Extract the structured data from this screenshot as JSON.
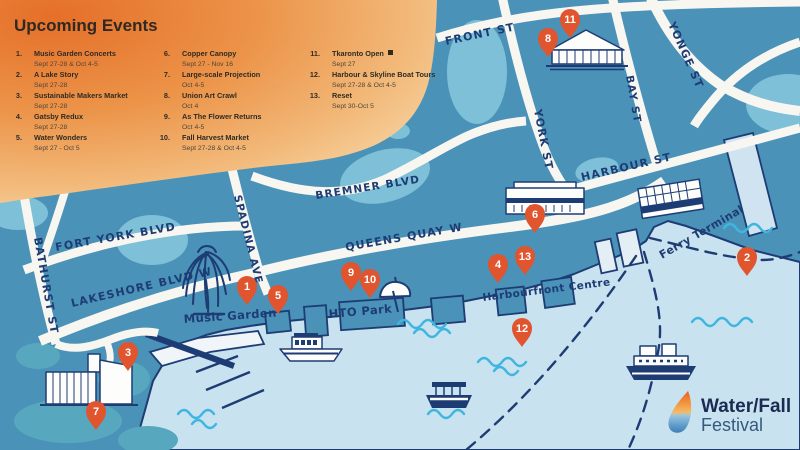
{
  "legend": {
    "title": "Upcoming Events",
    "items": [
      {
        "num": "1.",
        "name": "Music Garden Concerts",
        "dates": "Sept 27-28 & Oct 4-5"
      },
      {
        "num": "2.",
        "name": "A Lake Story",
        "dates": "Sept 27-28"
      },
      {
        "num": "3.",
        "name": "Sustainable Makers Market",
        "dates": "Sept 27-28"
      },
      {
        "num": "4.",
        "name": "Gatsby Redux",
        "dates": "Sept 27-28"
      },
      {
        "num": "5.",
        "name": "Water Wonders",
        "dates": "Sept 27 - Oct 5"
      },
      {
        "num": "6.",
        "name": "Copper Canopy",
        "dates": "Sept 27 - Nov 16"
      },
      {
        "num": "7.",
        "name": "Large-scale Projection",
        "dates": "Oct 4-5"
      },
      {
        "num": "8.",
        "name": "Union Art Crawl",
        "dates": "Oct 4"
      },
      {
        "num": "9.",
        "name": "As The Flower Returns",
        "dates": "Oct 4-5"
      },
      {
        "num": "10.",
        "name": "Fall Harvest Market",
        "dates": "Sept 27-28 & Oct 4-5"
      },
      {
        "num": "11.",
        "name": "Tkaronto Open",
        "dates": "Sept 27"
      },
      {
        "num": "12.",
        "name": "Harbour & Skyline Boat Tours",
        "dates": "Sept 27-28 & Oct 4-5"
      },
      {
        "num": "13.",
        "name": "Reset",
        "dates": "Sept 30-Oct 5"
      }
    ]
  },
  "map": {
    "streets": {
      "front": "FRONT ST",
      "yonge": "YONGE ST",
      "bay": "BAY ST",
      "york": "YORK ST",
      "harbour": "HARBOUR ST",
      "bremner": "BREMNER BLVD",
      "queens_quay": "QUEENS QUAY W",
      "spadina": "SPADINA AVE",
      "fort_york": "FORT YORK BLVD",
      "lakeshore": "LAKESHORE BLVD W",
      "bathurst": "BATHURST ST"
    },
    "places": {
      "music_garden": "Music Garden",
      "hto_park": "HTO Park",
      "harbourfront_centre": "Harbourfront Centre",
      "ferry_terminal": "Ferry Terminal"
    },
    "markers": [
      "1",
      "2",
      "3",
      "4",
      "5",
      "6",
      "7",
      "8",
      "9",
      "10",
      "11",
      "12",
      "13"
    ]
  },
  "logo": {
    "line1": "Water/Fall",
    "line2": "Festival"
  },
  "colors": {
    "legend_orange": "#E8752C",
    "marker": "#E0542E",
    "navy": "#1E3C74",
    "land": "#4A92B8",
    "water": "#C9E2EF",
    "wave": "#3FB6E0"
  }
}
